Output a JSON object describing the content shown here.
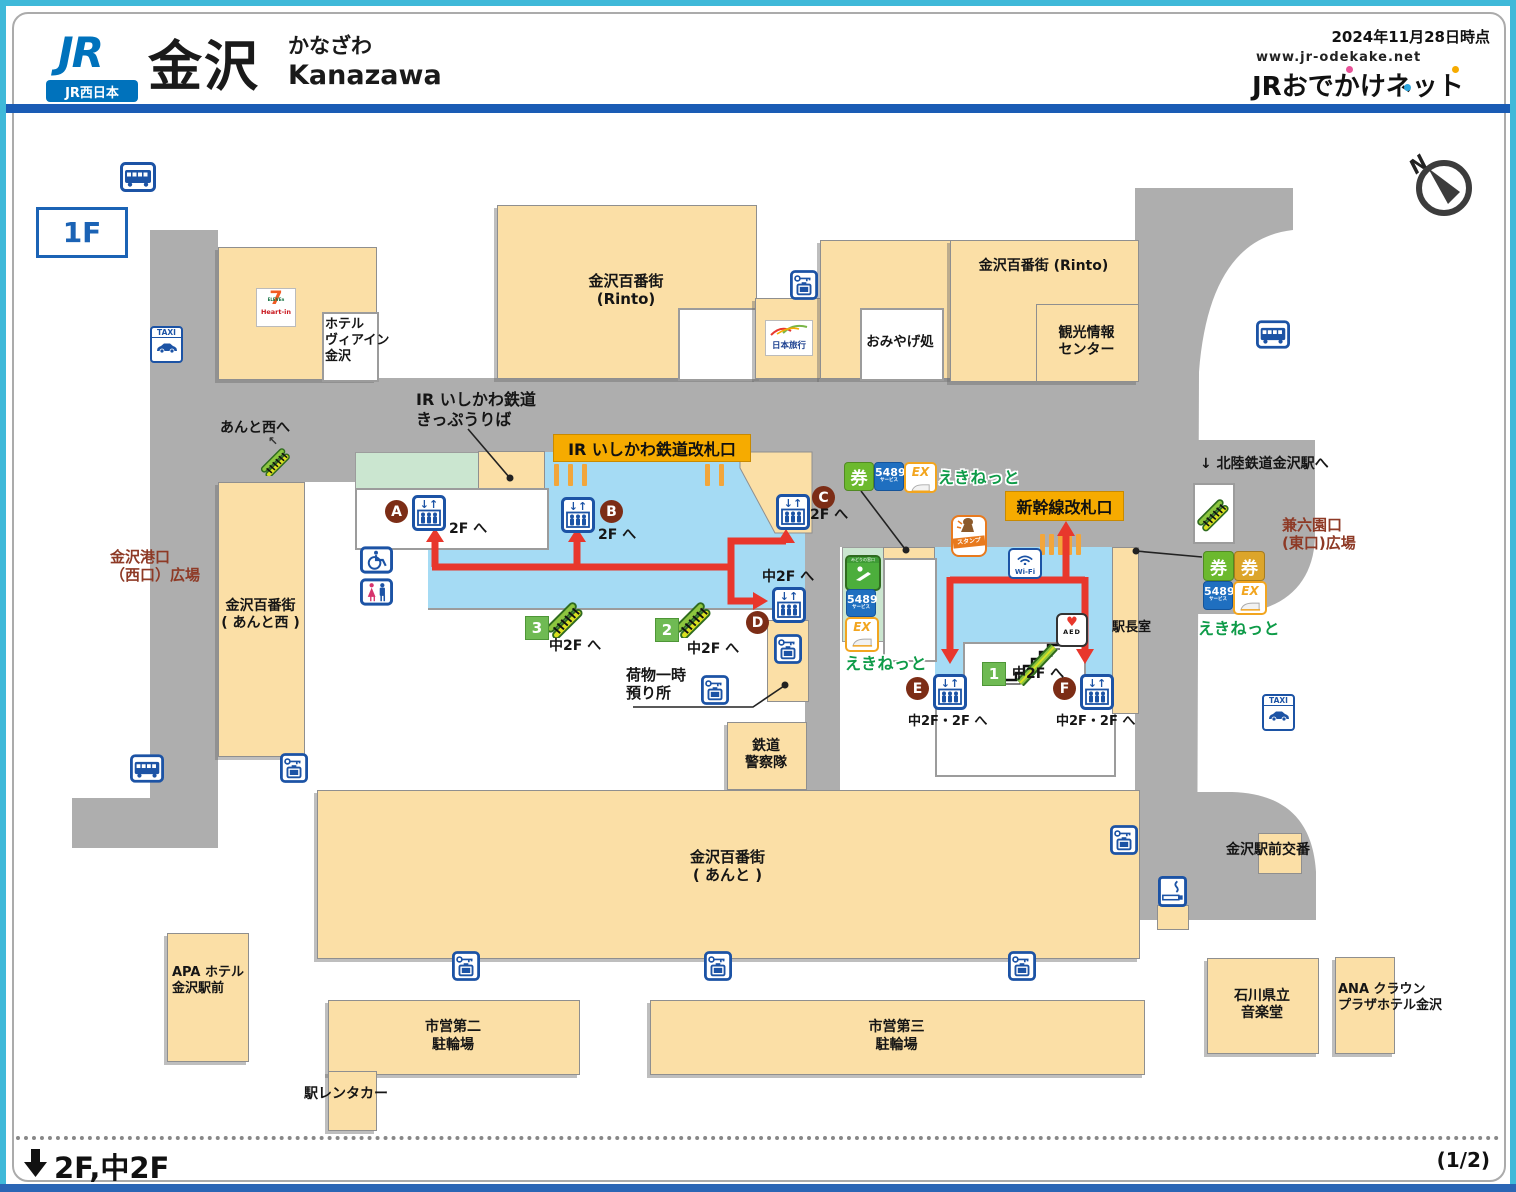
{
  "header": {
    "logo": "JR",
    "company": "JR西日本",
    "station": "金沢",
    "kana": "かなざわ",
    "romaji": "Kanazawa",
    "date": "2024年11月28日時点",
    "url": "www.jr-odekake.net",
    "site": "JRおでかけネット"
  },
  "floor": "1F",
  "compass": "N",
  "gates": {
    "ir": "IR いしかわ鉄道改札口",
    "shinkansen": "新幹線改札口"
  },
  "dest": {
    "f2": "2F へ",
    "m2": "中2F へ",
    "m2f2": "中2F・2F へ"
  },
  "elv": {
    "a": "A",
    "b": "B",
    "c": "C",
    "d": "D",
    "e": "E",
    "f": "F"
  },
  "esc": {
    "n1": "1",
    "n2": "2",
    "n3": "3"
  },
  "bld": {
    "rinto_c": "金沢百番街\n(Rinto)",
    "rinto_e": "金沢百番街 (Rinto)",
    "kanko": "観光情報\nセンター",
    "omiyage": "おみやげ処",
    "viainn": "ホテル\nヴィアイン\n金沢",
    "ir_office": "IR いしかわ鉄道\nきっぷうりば",
    "anto": "金沢百番街\n( あんと )",
    "anto_w": "金沢百番街\n( あんと西 )",
    "apa": "APA ホテル\n金沢駅前",
    "cycle2": "市営第二\n駐輪場",
    "cycle3": "市営第三\n駐輪場",
    "rent": "駅レンタカー",
    "ongaku": "石川県立\n音楽堂",
    "ana": "ANA クラウン\nプラザホテル金沢",
    "koban": "金沢駅前交番",
    "master": "駅長室",
    "police": "鉄道\n警察隊",
    "baggage": "荷物一時\n預り所"
  },
  "plaza": {
    "west": "金沢港口\n（西口）広場",
    "east": "兼六園口\n(東口)広場"
  },
  "dir": {
    "anto_west": "あんと西へ",
    "hokutetsu": "↓ 北陸鉄道金沢駅へ"
  },
  "sv": {
    "ekinet": "えきねっと",
    "s5489": "5489",
    "service": "サービス",
    "ex": "EX",
    "ken": "券",
    "wifi": "Wi-Fi",
    "aed": "AED",
    "stamp": "スタンプ",
    "taxi": "TAXI",
    "seven": "7",
    "eleven": "ELEVEn",
    "heartin": "Heart-in",
    "nihonryoko": "日本旅行",
    "midori": "みどりの窓口"
  },
  "footer": {
    "floors": "2F,中2F",
    "page": "(1/2)"
  }
}
